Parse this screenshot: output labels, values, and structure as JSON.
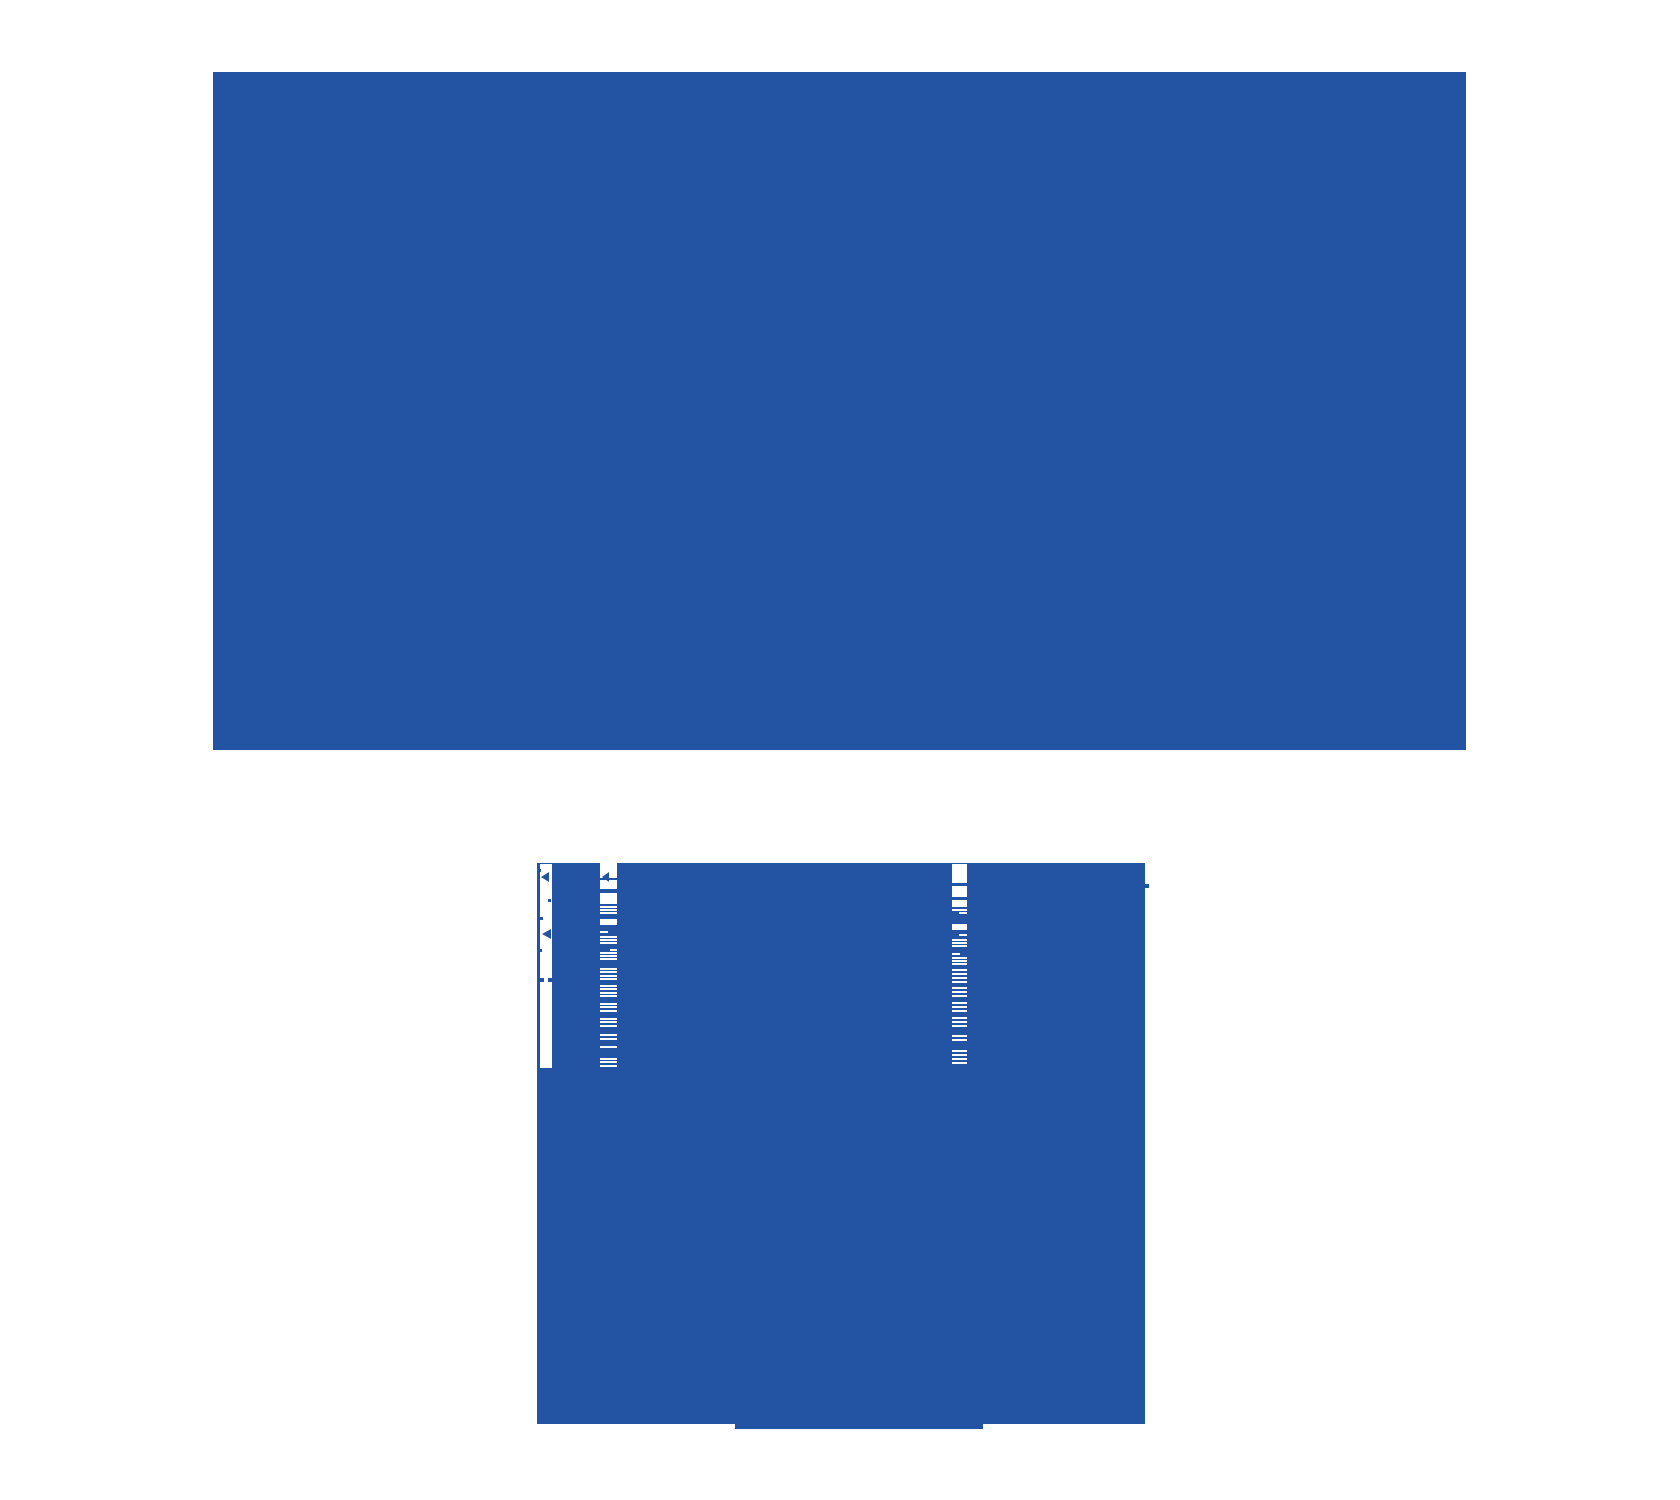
{
  "canvas": {
    "width": 1680,
    "height": 1500,
    "colors": {
      "background": "#ffffff",
      "blue": "#2254a3",
      "white": "#ffffff"
    }
  },
  "top_window": {
    "rect": {
      "x": 213,
      "y": 72,
      "w": 1253,
      "h": 678
    }
  },
  "bottom_window": {
    "rect": {
      "x": 537,
      "y": 863,
      "w": 608,
      "h": 561
    },
    "gutter": {
      "rect": {
        "x": 540,
        "y": 864,
        "w": 12,
        "h": 204
      },
      "marks": [
        {
          "kind": "dot",
          "x": 538,
          "y": 869,
          "s": 3
        },
        {
          "kind": "cursor",
          "x": 541,
          "y": 872,
          "w": 8,
          "h": 11
        },
        {
          "kind": "dot",
          "x": 548,
          "y": 899,
          "s": 3
        },
        {
          "kind": "dot",
          "x": 540,
          "y": 917,
          "s": 3
        },
        {
          "kind": "cursor",
          "x": 542,
          "y": 929,
          "w": 9,
          "h": 11
        },
        {
          "kind": "dot",
          "x": 539,
          "y": 949,
          "s": 3
        },
        {
          "kind": "dot",
          "x": 540,
          "y": 978,
          "s": 4
        },
        {
          "kind": "dot",
          "x": 548,
          "y": 978,
          "s": 4
        }
      ]
    },
    "columns": [
      {
        "x": 600,
        "w": 17,
        "marks": [
          {
            "kind": "cursor",
            "x": 602,
            "y": 872,
            "w": 7,
            "h": 10,
            "color": "blue"
          }
        ],
        "segments": [
          {
            "kind": "block",
            "y": 862,
            "h": 16
          },
          {
            "kind": "block",
            "y": 880,
            "h": 9
          },
          {
            "kind": "block",
            "y": 893,
            "h": 11
          },
          {
            "kind": "line",
            "y": 906,
            "h": 2
          },
          {
            "kind": "line",
            "y": 909,
            "h": 2
          },
          {
            "kind": "line",
            "y": 912,
            "h": 2
          },
          {
            "kind": "block",
            "y": 919,
            "h": 6
          },
          {
            "kind": "line",
            "y": 931,
            "h": 2,
            "w": 8
          },
          {
            "kind": "line",
            "y": 936,
            "h": 2
          },
          {
            "kind": "line",
            "y": 939,
            "h": 2
          },
          {
            "kind": "line",
            "y": 942,
            "h": 2
          },
          {
            "kind": "line",
            "y": 949,
            "h": 2,
            "w": 7,
            "align": "right"
          },
          {
            "kind": "line",
            "y": 952,
            "h": 2
          },
          {
            "kind": "line",
            "y": 955,
            "h": 2
          },
          {
            "kind": "line",
            "y": 958,
            "h": 2
          },
          {
            "kind": "line",
            "y": 968,
            "h": 2
          },
          {
            "kind": "line",
            "y": 971,
            "h": 2
          },
          {
            "kind": "line",
            "y": 975,
            "h": 2
          },
          {
            "kind": "line",
            "y": 978,
            "h": 2
          },
          {
            "kind": "line",
            "y": 985,
            "h": 2
          },
          {
            "kind": "line",
            "y": 988,
            "h": 2
          },
          {
            "kind": "line",
            "y": 992,
            "h": 2
          },
          {
            "kind": "line",
            "y": 995,
            "h": 2
          },
          {
            "kind": "line",
            "y": 1003,
            "h": 2
          },
          {
            "kind": "line",
            "y": 1006,
            "h": 2
          },
          {
            "kind": "line",
            "y": 1010,
            "h": 2
          },
          {
            "kind": "line",
            "y": 1018,
            "h": 2
          },
          {
            "kind": "line",
            "y": 1021,
            "h": 2
          },
          {
            "kind": "line",
            "y": 1025,
            "h": 2
          },
          {
            "kind": "line",
            "y": 1034,
            "h": 2
          },
          {
            "kind": "line",
            "y": 1038,
            "h": 2
          },
          {
            "kind": "line",
            "y": 1046,
            "h": 2
          },
          {
            "kind": "line",
            "y": 1058,
            "h": 2
          },
          {
            "kind": "line",
            "y": 1061,
            "h": 2
          },
          {
            "kind": "line",
            "y": 1065,
            "h": 2
          }
        ]
      },
      {
        "x": 952,
        "w": 15,
        "marks": [],
        "segments": [
          {
            "kind": "block",
            "y": 864,
            "h": 19
          },
          {
            "kind": "block",
            "y": 886,
            "h": 11
          },
          {
            "kind": "block",
            "y": 900,
            "h": 7
          },
          {
            "kind": "line",
            "y": 909,
            "h": 2
          },
          {
            "kind": "line",
            "y": 912,
            "h": 2,
            "w": 8,
            "align": "right"
          },
          {
            "kind": "block",
            "y": 924,
            "h": 6
          },
          {
            "kind": "line",
            "y": 934,
            "h": 2,
            "w": 8,
            "align": "right"
          },
          {
            "kind": "line",
            "y": 939,
            "h": 2
          },
          {
            "kind": "line",
            "y": 942,
            "h": 2
          },
          {
            "kind": "line",
            "y": 945,
            "h": 2
          },
          {
            "kind": "line",
            "y": 953,
            "h": 2,
            "w": 8
          },
          {
            "kind": "line",
            "y": 957,
            "h": 2
          },
          {
            "kind": "line",
            "y": 960,
            "h": 2
          },
          {
            "kind": "line",
            "y": 963,
            "h": 2
          },
          {
            "kind": "line",
            "y": 969,
            "h": 2
          },
          {
            "kind": "line",
            "y": 973,
            "h": 2
          },
          {
            "kind": "line",
            "y": 977,
            "h": 2
          },
          {
            "kind": "line",
            "y": 981,
            "h": 2
          },
          {
            "kind": "line",
            "y": 987,
            "h": 2
          },
          {
            "kind": "line",
            "y": 991,
            "h": 2
          },
          {
            "kind": "line",
            "y": 995,
            "h": 2
          },
          {
            "kind": "line",
            "y": 1002,
            "h": 2
          },
          {
            "kind": "line",
            "y": 1006,
            "h": 2
          },
          {
            "kind": "line",
            "y": 1010,
            "h": 2
          },
          {
            "kind": "line",
            "y": 1017,
            "h": 2
          },
          {
            "kind": "line",
            "y": 1021,
            "h": 2
          },
          {
            "kind": "line",
            "y": 1025,
            "h": 2
          },
          {
            "kind": "line",
            "y": 1035,
            "h": 2
          },
          {
            "kind": "line",
            "y": 1039,
            "h": 2
          },
          {
            "kind": "line",
            "y": 1050,
            "h": 2
          },
          {
            "kind": "line",
            "y": 1054,
            "h": 2
          },
          {
            "kind": "line",
            "y": 1058,
            "h": 2
          },
          {
            "kind": "line",
            "y": 1062,
            "h": 2
          }
        ]
      }
    ],
    "nub": {
      "x": 1145,
      "y": 884,
      "w": 4,
      "h": 4
    },
    "bottom_tab": {
      "x": 735,
      "y": 1424,
      "w": 248,
      "h": 5
    }
  }
}
